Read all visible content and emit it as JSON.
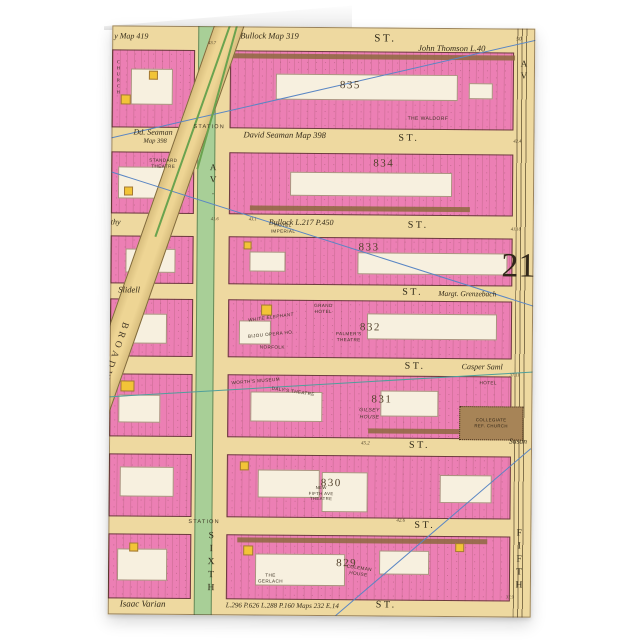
{
  "plate": {
    "number": "21"
  },
  "avenues": {
    "sixth_av": "AV.",
    "sixth": "SIXTH",
    "fifth": "FIFTH",
    "fifth_av": "AV",
    "broadway": "BROADWAY"
  },
  "rows": [
    {
      "ref_left": "y Map 419",
      "ref_center": "Bullock Map 319",
      "st": "ST.",
      "owner": "John Thomson L.40",
      "n1": "43.7",
      "n2": "50"
    },
    {
      "owner_l1": "Dd. Seaman",
      "owner_l2": "Map 398",
      "station": "STATION",
      "ref_center": "David Seaman Map 398",
      "st": "ST.",
      "n1": "42.4"
    },
    {
      "ref_left": "thy",
      "n1": "41.6",
      "n2": "43.1",
      "ref_center": "Bullock L.217 P.450",
      "st": "ST.",
      "n3": "41.10"
    },
    {
      "ref_left": "Slidell",
      "st": "ST.",
      "owner": "Margt. Grenzebach"
    },
    {
      "st": "ST.",
      "owner": "Casper Saml",
      "n1": "37.11"
    },
    {
      "n1": "45.2",
      "st": "ST.",
      "owner": "Susan"
    },
    {
      "station": "STATION",
      "st": "ST.",
      "n1": "42.6"
    },
    {
      "ref_left": "Isaac Varian",
      "ref_center": "L.296 P.626 L.288 P.160 Maps 232 E.14",
      "st": "ST.",
      "n1": "37.9"
    }
  ],
  "blocks": [
    "835",
    "834",
    "833",
    "832",
    "831",
    "830",
    "829"
  ],
  "buildings": {
    "church": "CHURCH",
    "waldorf": "THE WALDORF",
    "standard": [
      "STANDARD",
      "THEATRE"
    ],
    "imperial": [
      "HOTEL",
      "IMPERIAL"
    ],
    "white_elephant": "WHITE ELEPHANT",
    "bijou": "BIJOU OPERA HO.",
    "norfolk": "NORFOLK",
    "grand_hotel": [
      "GRAND",
      "HOTEL"
    ],
    "palmers": [
      "PALMER'S",
      "THEATRE"
    ],
    "worths": "WORTH'S MUSEUM",
    "dalys": "DALY'S THEATRE",
    "gilsey": [
      "GILSEY",
      "HOUSE"
    ],
    "hotel": "HOTEL",
    "collegiate": [
      "COLLEGIATE",
      "REF. CHURCH"
    ],
    "fifth_ave_theatre": [
      "NEW",
      "FIFTH AVE",
      "THEATRE"
    ],
    "gerlach": [
      "THE",
      "GERLACH"
    ],
    "coleman": [
      "COLEMAN",
      "HOUSE"
    ]
  },
  "colors": {
    "block_pink": "#ec7fb4",
    "paper_tan": "#eed9a0",
    "avenue_green": "#a8cf97",
    "water_blue": "#8fc3e8",
    "survey_blue": "#5a86c4",
    "church_brown": "#a78457"
  }
}
